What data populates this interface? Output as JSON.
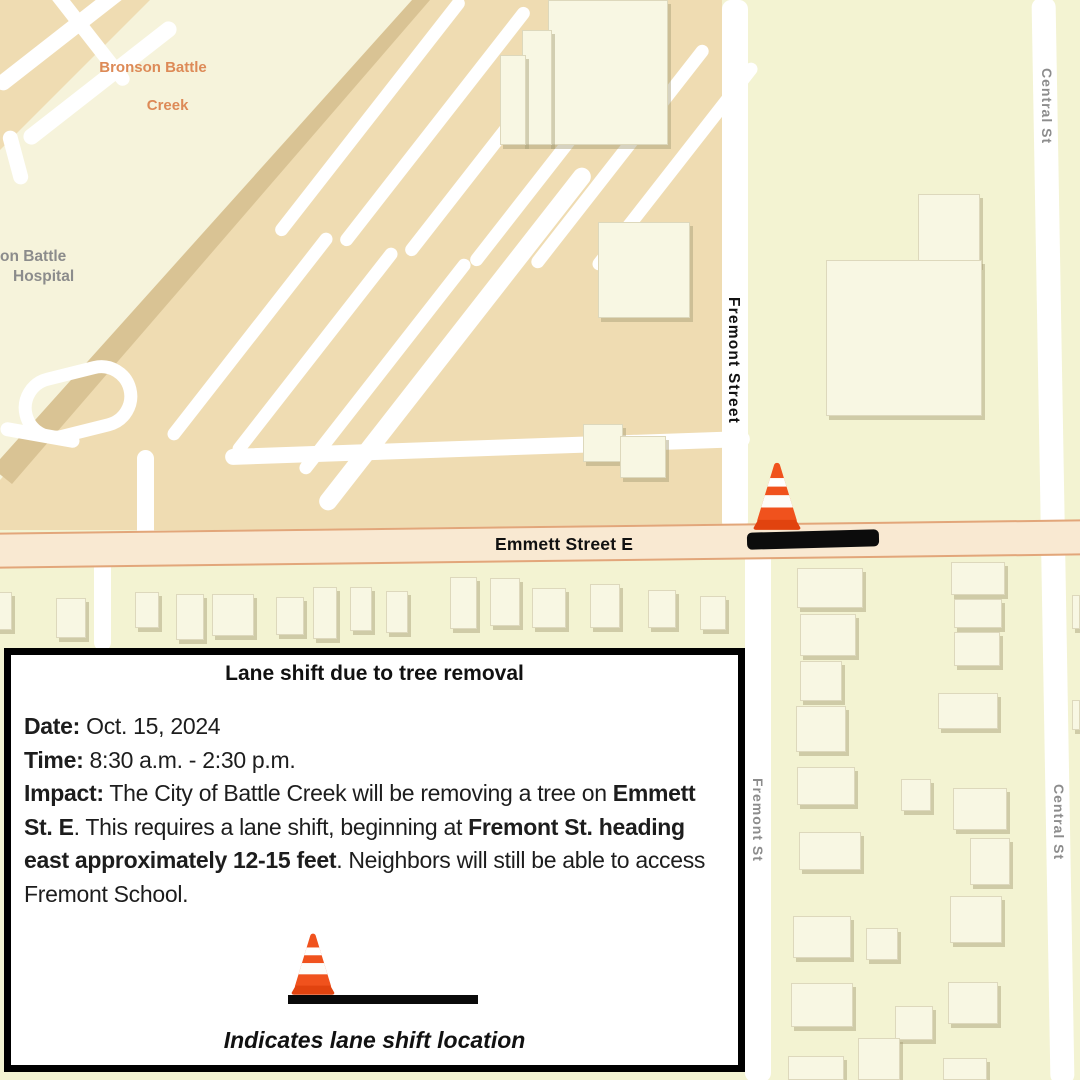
{
  "map": {
    "colors": {
      "pale": "#f3f3d2",
      "tan": "#efdcb2",
      "cream": "#f6f3db",
      "bandedge": "#d9c394",
      "road": "#ffffff",
      "bldg": "#f8f7e3",
      "emmettfill": "#f9e9d2",
      "emmettborder": "#e2a67a",
      "labelorange": "#dd8a57",
      "labelgray": "#8c8c8c",
      "coneorange": "#f0521d",
      "conebase": "#e1430f",
      "ink": "#111111"
    },
    "labels": {
      "bronson": [
        "Bronson Battle",
        "Creek"
      ],
      "hospital": [
        "on Battle",
        "Hospital"
      ],
      "fremont_street": "Fremont Street",
      "fremont_st": "Fremont St",
      "central_st_north": "Central St",
      "central_st_south": "Central St",
      "emmett": "Emmett Street E"
    },
    "roads": [
      {
        "x": -20,
        "y": 30,
        "w": 160,
        "h": 16,
        "r": -38
      },
      {
        "x": 5,
        "y": 75,
        "w": 190,
        "h": 16,
        "r": -38
      },
      {
        "x": 30,
        "y": 30,
        "w": 120,
        "h": 14,
        "r": 52
      },
      {
        "x": 8,
        "y": 130,
        "w": 15,
        "h": 55,
        "r": -15
      },
      {
        "x": 240,
        "y": 330,
        "w": 430,
        "h": 18,
        "r": -52
      },
      {
        "x": 225,
        "y": 440,
        "w": 525,
        "h": 16,
        "r": -2
      },
      {
        "x": 137,
        "y": 450,
        "w": 17,
        "h": 92,
        "r": 0
      },
      {
        "x": 18,
        "y": 366,
        "w": 120,
        "h": 72,
        "r": -14,
        "loop": true
      },
      {
        "x": 0,
        "y": 428,
        "w": 80,
        "h": 14,
        "r": 10
      },
      {
        "x": 220,
        "y": 110,
        "w": 300,
        "h": 13,
        "r": -52
      },
      {
        "x": 285,
        "y": 120,
        "w": 300,
        "h": 13,
        "r": -52
      },
      {
        "x": 350,
        "y": 130,
        "w": 300,
        "h": 13,
        "r": -52
      },
      {
        "x": 415,
        "y": 140,
        "w": 300,
        "h": 13,
        "r": -52
      },
      {
        "x": 480,
        "y": 150,
        "w": 280,
        "h": 13,
        "r": -52
      },
      {
        "x": 545,
        "y": 160,
        "w": 260,
        "h": 13,
        "r": -52
      },
      {
        "x": 120,
        "y": 330,
        "w": 260,
        "h": 13,
        "r": -52
      },
      {
        "x": 185,
        "y": 345,
        "w": 260,
        "h": 13,
        "r": -52
      },
      {
        "x": 250,
        "y": 360,
        "w": 270,
        "h": 13,
        "r": -52
      },
      {
        "x": 722,
        "y": 0,
        "w": 26,
        "h": 530,
        "r": 0
      },
      {
        "x": 745,
        "y": 528,
        "w": 26,
        "h": 554,
        "r": 0
      },
      {
        "x": 1041,
        "y": -2,
        "w": 24,
        "h": 1086,
        "r": -1
      },
      {
        "x": 94,
        "y": 556,
        "w": 17,
        "h": 95,
        "r": 0
      }
    ],
    "buildings": [
      {
        "x": 548,
        "y": 0,
        "w": 120,
        "h": 145
      },
      {
        "x": 522,
        "y": 30,
        "w": 30,
        "h": 115
      },
      {
        "x": 500,
        "y": 55,
        "w": 26,
        "h": 90
      },
      {
        "x": 598,
        "y": 222,
        "w": 92,
        "h": 96
      },
      {
        "x": 583,
        "y": 424,
        "w": 40,
        "h": 38
      },
      {
        "x": 620,
        "y": 436,
        "w": 46,
        "h": 42
      },
      {
        "x": 918,
        "y": 194,
        "w": 62,
        "h": 72
      },
      {
        "x": 826,
        "y": 260,
        "w": 156,
        "h": 156
      },
      {
        "x": -6,
        "y": 592,
        "w": 18,
        "h": 38
      },
      {
        "x": 56,
        "y": 598,
        "w": 30,
        "h": 40
      },
      {
        "x": 135,
        "y": 592,
        "w": 24,
        "h": 36
      },
      {
        "x": 176,
        "y": 594,
        "w": 28,
        "h": 46
      },
      {
        "x": 212,
        "y": 594,
        "w": 42,
        "h": 42
      },
      {
        "x": 276,
        "y": 597,
        "w": 28,
        "h": 38
      },
      {
        "x": 313,
        "y": 587,
        "w": 24,
        "h": 52
      },
      {
        "x": 350,
        "y": 587,
        "w": 22,
        "h": 44
      },
      {
        "x": 386,
        "y": 591,
        "w": 22,
        "h": 42
      },
      {
        "x": 450,
        "y": 577,
        "w": 27,
        "h": 52
      },
      {
        "x": 490,
        "y": 578,
        "w": 30,
        "h": 48
      },
      {
        "x": 532,
        "y": 588,
        "w": 34,
        "h": 40
      },
      {
        "x": 590,
        "y": 584,
        "w": 30,
        "h": 44
      },
      {
        "x": 648,
        "y": 590,
        "w": 28,
        "h": 38
      },
      {
        "x": 700,
        "y": 596,
        "w": 26,
        "h": 34
      },
      {
        "x": 797,
        "y": 568,
        "w": 66,
        "h": 40
      },
      {
        "x": 800,
        "y": 614,
        "w": 56,
        "h": 42
      },
      {
        "x": 800,
        "y": 661,
        "w": 42,
        "h": 40
      },
      {
        "x": 796,
        "y": 706,
        "w": 50,
        "h": 46
      },
      {
        "x": 797,
        "y": 767,
        "w": 58,
        "h": 38
      },
      {
        "x": 799,
        "y": 832,
        "w": 62,
        "h": 38
      },
      {
        "x": 951,
        "y": 562,
        "w": 54,
        "h": 33
      },
      {
        "x": 954,
        "y": 599,
        "w": 48,
        "h": 29
      },
      {
        "x": 954,
        "y": 632,
        "w": 46,
        "h": 34
      },
      {
        "x": 938,
        "y": 693,
        "w": 60,
        "h": 36
      },
      {
        "x": 901,
        "y": 779,
        "w": 30,
        "h": 32
      },
      {
        "x": 953,
        "y": 788,
        "w": 54,
        "h": 42
      },
      {
        "x": 970,
        "y": 838,
        "w": 40,
        "h": 47
      },
      {
        "x": 793,
        "y": 916,
        "w": 58,
        "h": 42
      },
      {
        "x": 866,
        "y": 928,
        "w": 32,
        "h": 32
      },
      {
        "x": 950,
        "y": 896,
        "w": 52,
        "h": 47
      },
      {
        "x": 791,
        "y": 983,
        "w": 62,
        "h": 44
      },
      {
        "x": 895,
        "y": 1006,
        "w": 38,
        "h": 34
      },
      {
        "x": 948,
        "y": 982,
        "w": 50,
        "h": 42
      },
      {
        "x": 858,
        "y": 1038,
        "w": 42,
        "h": 42
      },
      {
        "x": 788,
        "y": 1056,
        "w": 56,
        "h": 24
      },
      {
        "x": 943,
        "y": 1058,
        "w": 44,
        "h": 22
      },
      {
        "x": 1072,
        "y": 595,
        "w": 8,
        "h": 34
      },
      {
        "x": 1072,
        "y": 700,
        "w": 8,
        "h": 30
      }
    ],
    "cones": [
      {
        "x": 748,
        "y": 460,
        "w": 58,
        "h": 76
      }
    ],
    "bars": [
      {
        "x": 747,
        "y": 531,
        "w": 132,
        "h": 17,
        "r": -1.5
      }
    ]
  },
  "notice": {
    "title": "Lane shift due to tree removal",
    "lines": [
      {
        "label": "Date:",
        "value": "Oct. 15, 2024"
      },
      {
        "label": "Time:",
        "value": "8:30 a.m. - 2:30 p.m."
      }
    ],
    "impact_segments": [
      {
        "text": "Impact:",
        "bold": true
      },
      {
        "text": " The City of Battle Creek will be removing a tree on ",
        "bold": false
      },
      {
        "text": "Emmett St. E",
        "bold": true
      },
      {
        "text": ". This requires a lane shift, beginning at ",
        "bold": false
      },
      {
        "text": "Fremont St. heading east approximately 12-15 feet",
        "bold": true
      },
      {
        "text": ". Neighbors will still be able to access Fremont School.",
        "bold": false
      }
    ],
    "legend_caption": "Indicates lane shift location"
  }
}
